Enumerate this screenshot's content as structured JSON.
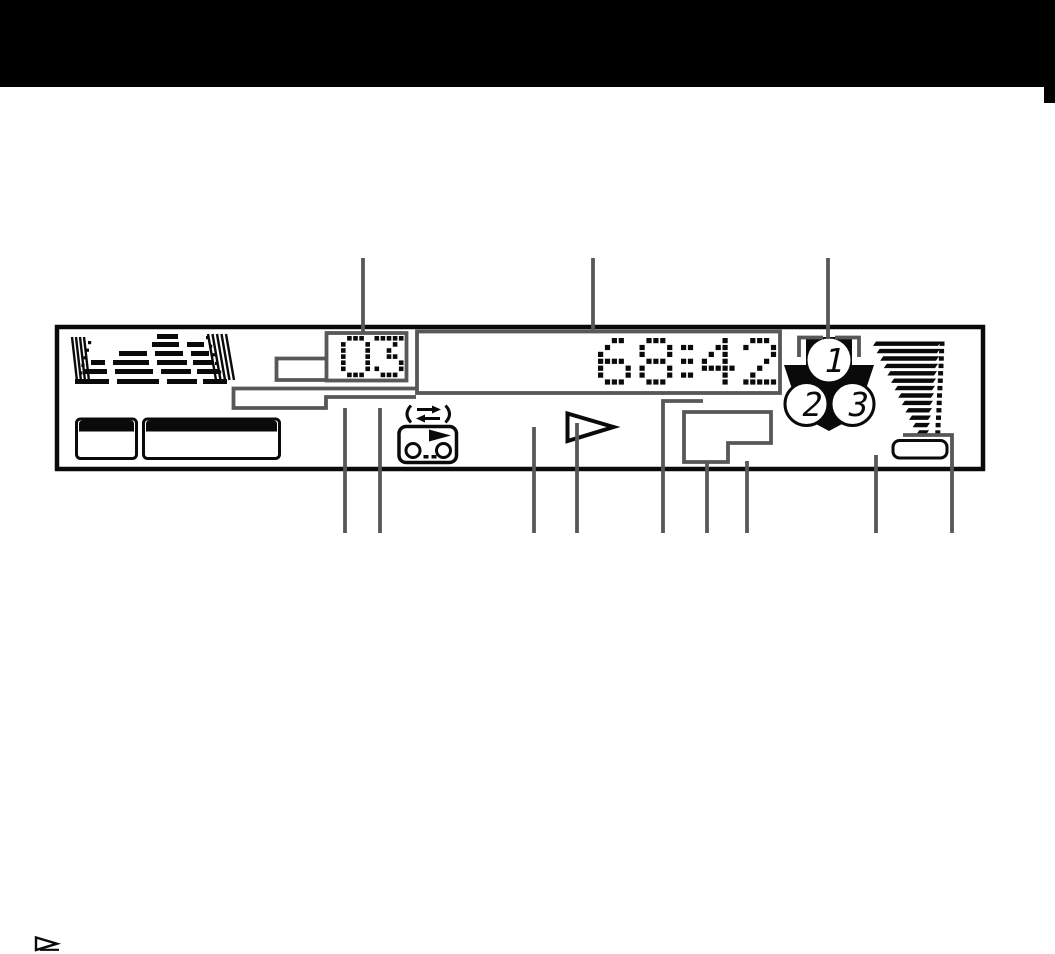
{
  "header": {
    "bar_color": "#000000"
  },
  "display": {
    "track_number": "03",
    "time": "68:42",
    "disc_numbers": [
      "1",
      "2",
      "3"
    ],
    "colors": {
      "ink": "#0a0a0a",
      "callout_gray": "#58585a",
      "background": "#ffffff"
    },
    "icons": [
      "equalizer-burst-graphic",
      "program-box-small",
      "program-box-large",
      "auto-reverse-icon",
      "cassette-icon",
      "play-triangle-icon",
      "disc-stack-indicator",
      "disc-select-bracket",
      "volume-wedge-graphic",
      "battery-pill-outline"
    ]
  },
  "footer": {
    "marker_icon": "play-triangle-marker"
  }
}
